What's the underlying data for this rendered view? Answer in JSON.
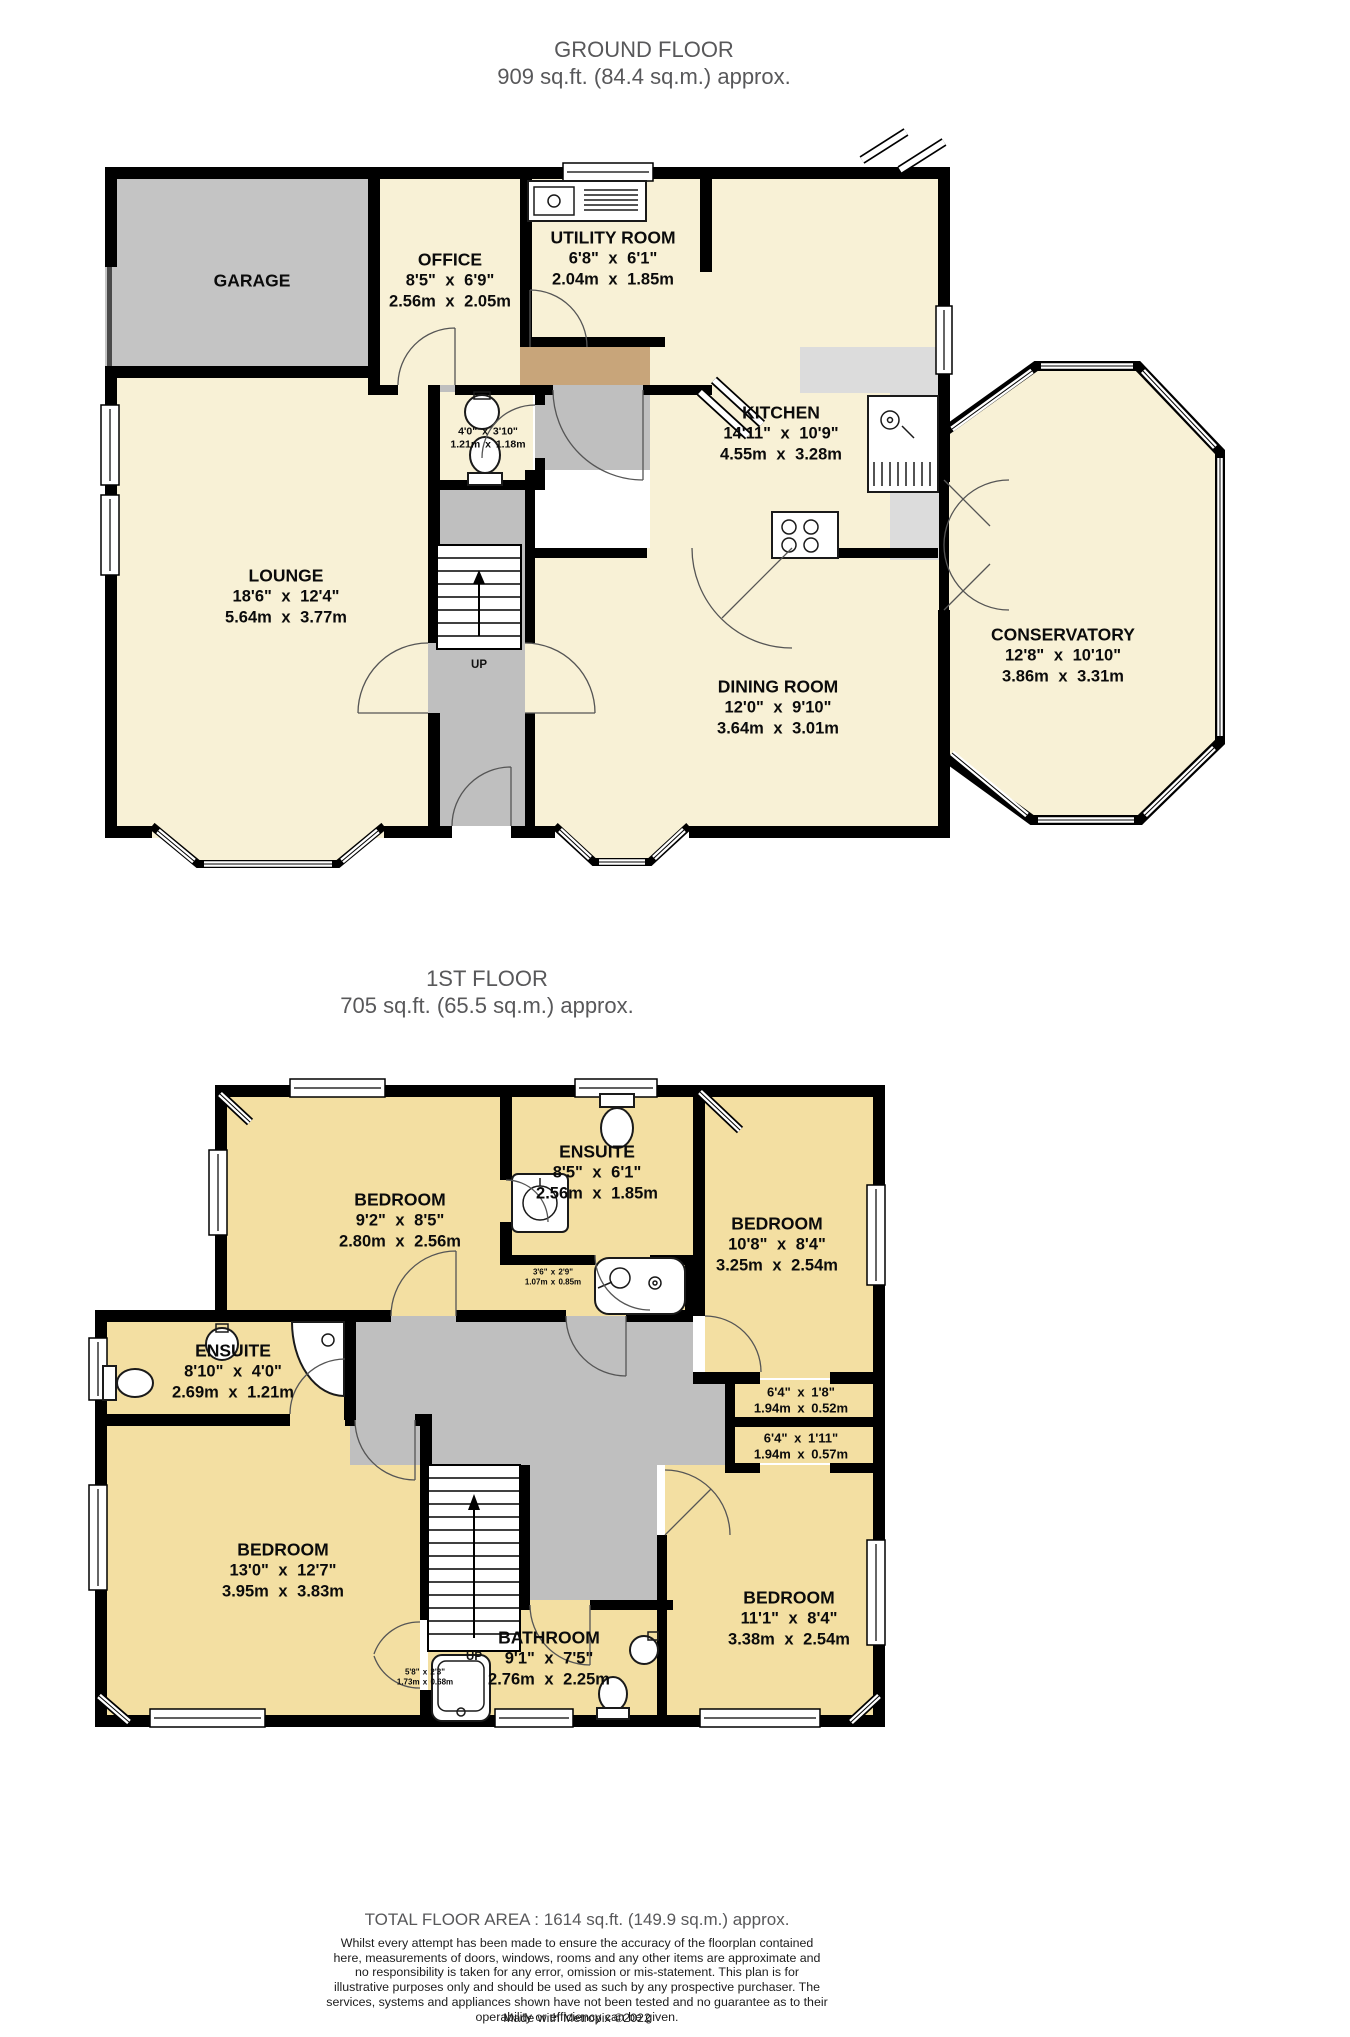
{
  "palette": {
    "room_cream": "#F8F1D6",
    "room_tan": "#F3DFA2",
    "garage_gray": "#C4C4C4",
    "hall_gray": "#BFBFBF",
    "porch_brown": "#C8A57A",
    "counter_gray": "#DCDCDC",
    "wall_black": "#000000",
    "title_gray": "#58585A"
  },
  "ground": {
    "title": "GROUND FLOOR",
    "area": "909 sq.ft. (84.4 sq.m.) approx.",
    "up": "UP",
    "garage": {
      "name": "GARAGE"
    },
    "office": {
      "name": "OFFICE",
      "ft": "8'5\" x 6'9\"",
      "m": "2.56m x 2.05m"
    },
    "utility": {
      "name": "UTILITY ROOM",
      "ft": "6'8\" x 6'1\"",
      "m": "2.04m x 1.85m"
    },
    "kitchen": {
      "name": "KITCHEN",
      "ft": "14'11\" x 10'9\"",
      "m": "4.55m x 3.28m"
    },
    "wc": {
      "ft": "4'0\" x 3'10\"",
      "m": "1.21m x 1.18m"
    },
    "lounge": {
      "name": "LOUNGE",
      "ft": "18'6\" x 12'4\"",
      "m": "5.64m x 3.77m"
    },
    "dining": {
      "name": "DINING ROOM",
      "ft": "12'0\" x 9'10\"",
      "m": "3.64m x 3.01m"
    },
    "conservatory": {
      "name": "CONSERVATORY",
      "ft": "12'8\" x 10'10\"",
      "m": "3.86m x 3.31m"
    }
  },
  "first": {
    "title": "1ST FLOOR",
    "area": "705 sq.ft. (65.5 sq.m.) approx.",
    "up": "UP",
    "bedroom_tl": {
      "name": "BEDROOM",
      "ft": "9'2\" x 8'5\"",
      "m": "2.80m x 2.56m"
    },
    "ensuite_top": {
      "name": "ENSUITE",
      "ft": "8'5\" x 6'1\"",
      "m": "2.56m x 1.85m"
    },
    "bedroom_tr": {
      "name": "BEDROOM",
      "ft": "10'8\" x 8'4\"",
      "m": "3.25m x 2.54m"
    },
    "ensuite_left": {
      "name": "ENSUITE",
      "ft": "8'10\" x 4'0\"",
      "m": "2.69m x 1.21m"
    },
    "corridor": {
      "ft": "3'6\" x 2'9\"",
      "m": "1.07m x 0.85m"
    },
    "cupboard1": {
      "ft": "6'4\" x 1'8\"",
      "m": "1.94m x 0.52m"
    },
    "cupboard2": {
      "ft": "6'4\" x 1'11\"",
      "m": "1.94m x 0.57m"
    },
    "bedroom_bl": {
      "name": "BEDROOM",
      "ft": "13'0\" x 12'7\"",
      "m": "3.95m x 3.83m"
    },
    "closet": {
      "ft": "5'8\" x 2'3\"",
      "m": "1.73m x 0.68m"
    },
    "bathroom": {
      "name": "BATHROOM",
      "ft": "9'1\" x 7'5\"",
      "m": "2.76m x 2.25m"
    },
    "bedroom_br": {
      "name": "BEDROOM",
      "ft": "11'1\" x 8'4\"",
      "m": "3.38m x 2.54m"
    }
  },
  "footer": {
    "total": "TOTAL FLOOR AREA : 1614 sq.ft. (149.9 sq.m.) approx.",
    "disclaimer": "Whilst every attempt has been made to ensure the accuracy of the floorplan contained here, measurements of doors, windows, rooms and any other items are approximate and no responsibility is taken for any error, omission or mis-statement. This plan is for illustrative purposes only and should be used as such by any prospective purchaser. The services, systems and appliances shown have not been tested and no guarantee as to their operability or efficiency can be given.",
    "credit": "Made with Metropix ©2022"
  }
}
